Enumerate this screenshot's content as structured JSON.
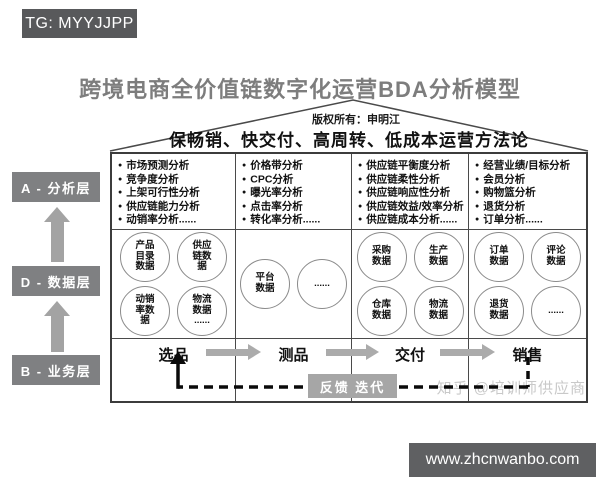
{
  "badge": {
    "text": "TG: MYYJJPP"
  },
  "title": "跨境电商全价值链数字化运营BDA分析模型",
  "roof": {
    "copyright": "版权所有：申明江",
    "slogan": "保畅销、快交付、高周转、低成本运营方法论"
  },
  "layers": [
    {
      "id": "analysis",
      "label": "A - 分析层"
    },
    {
      "id": "data",
      "label": "D - 数据层"
    },
    {
      "id": "business",
      "label": "B - 业务层"
    }
  ],
  "columns": [
    {
      "analysis_items": [
        "市场预测分析",
        "竞争度分析",
        "上架可行性分析",
        "供应链能力分析",
        "动销率分析......"
      ],
      "data_circles": [
        "产品\n目录\n数据",
        "供应\n链数\n据",
        "动销\n率数\n据",
        "物流\n数据\n......"
      ],
      "business_step": "选品"
    },
    {
      "analysis_items": [
        "价格带分析",
        "CPC分析",
        "曝光率分析",
        "点击率分析",
        "转化率分析......"
      ],
      "data_circles": [
        "平台\n数据",
        "......"
      ],
      "business_step": "测品"
    },
    {
      "analysis_items": [
        "供应链平衡度分析",
        "供应链柔性分析",
        "供应链响应性分析",
        "供应链效益/效率分析",
        "供应链成本分析......"
      ],
      "data_circles": [
        "采购\n数据",
        "生产\n数据",
        "仓库\n数据",
        "物流\n数据"
      ],
      "business_step": "交付"
    },
    {
      "analysis_items": [
        "经营业绩/目标分析",
        "会员分析",
        "购物篮分析",
        "退货分析",
        "订单分析......"
      ],
      "data_circles": [
        "订单\n数据",
        "评论\n数据",
        "退货\n数据",
        "......"
      ],
      "business_step": "销售"
    }
  ],
  "feedback": {
    "label": "反馈 迭代"
  },
  "watermark": "知乎 @培训师供应商",
  "footer": {
    "url": "www.zhcnwanbo.com"
  },
  "colors": {
    "badge_bg": "#58595b",
    "title_text": "#7d7d7d",
    "layer_box_bg": "#7f8082",
    "flow_arrow": "#ababab",
    "feedback_box_bg": "#a6a6a6",
    "footer_bg": "#5f6062",
    "watermark_text": "#c9c9c9",
    "table_border": "#3c3c3c"
  }
}
